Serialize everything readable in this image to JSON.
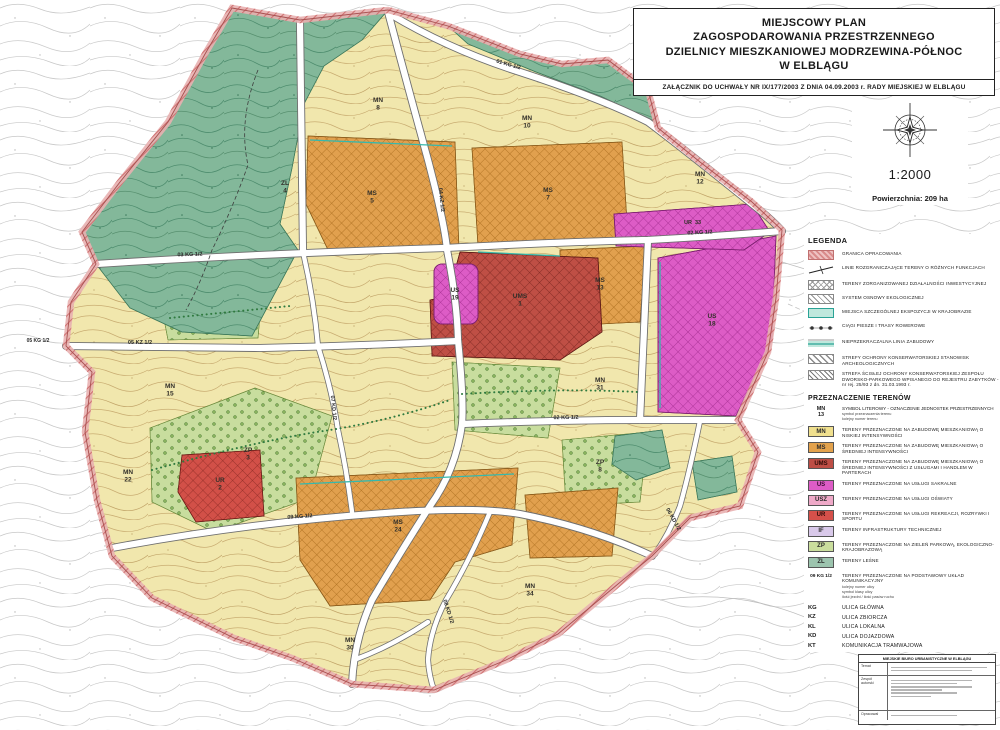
{
  "title_block": {
    "line1": "MIEJSCOWY PLAN",
    "line2": "ZAGOSPODAROWANIA PRZESTRZENNEGO",
    "line3": "DZIELNICY MIESZKANIOWEJ MODRZEWINA-PÓŁNOC",
    "line4": "W ELBLĄGU",
    "attachment": "ZAŁĄCZNIK DO UCHWAŁY  NR IX/177/2003  Z DNIA  04.09.2003 r.  RADY MIEJSKIEJ W ELBLĄGU"
  },
  "scale_text": "1:2000",
  "area_text": "Powierzchnia: 209 ha",
  "legend": {
    "heading": "LEGENDA",
    "items": [
      {
        "label": "GRANICA OPRACOWANIA"
      },
      {
        "label": "LINIE ROZGRANICZAJĄCE TERENY O RÓŻNYCH FUNKCJACH"
      },
      {
        "label": "TERENY ZORGANIZOWANEJ DZIAŁALNOŚCI INWESTYCYJNEJ"
      },
      {
        "label": "SYSTEM OSNOWY EKOLOGICZNEJ"
      },
      {
        "label": "MIEJSCA SZCZEGÓLNEJ EKSPOZYCJI W KRAJOBRAZIE"
      },
      {
        "label": "CIĄGI PIESZE I TRASY ROWEROWE"
      },
      {
        "label": "NIEPRZEKRACZALNA LINIA ZABUDOWY"
      },
      {
        "label": "STREFY OCHRONY KONSERWATORSKIEJ STANOWISK ARCHEOLOGICZNYCH"
      },
      {
        "label": "STREFA ŚCISŁEJ OCHRONY KONSERWATORSKIEJ ZESPOŁU DWORSKO-PARKOWEGO WPISANEGO DO REJESTRU ZABYTKÓW - nr rej. 25/93 z dn. 31.03.1993 r."
      }
    ]
  },
  "zoning": {
    "heading": "PRZEZNACZENIE TERENÓW",
    "symbol_note": {
      "code_top": "MN",
      "code_num": "13",
      "label": "SYMBOL LITEROWY - OZNACZENIE JEDNOSTEK PRZESTRZENNYCH",
      "sub1": "symbol przeznaczenia terenu",
      "sub2": "kolejny numer terenu"
    },
    "items": [
      {
        "code": "MN",
        "color": "#f0e08e",
        "label": "TERENY PRZEZNACZONE NA ZABUDOWĘ MIESZKANIOWĄ O NISKIEJ INTENSYWNOŚCI"
      },
      {
        "code": "MS",
        "color": "#e3a24c",
        "label": "TERENY PRZEZNACZONE NA ZABUDOWĘ MIESZKANIOWĄ O ŚREDNIEJ INTENSYWNOŚCI"
      },
      {
        "code": "UMS",
        "color": "#bd4d45",
        "label": "TERENY PRZEZNACZONE NA ZABUDOWĘ MIESZKANIOWĄ O ŚREDNIEJ INTENSYWNOŚCI Z USŁUGAMI I HANDLEM W PARTERACH"
      },
      {
        "code": "US",
        "color": "#dd5cc6",
        "label": "TERENY PRZEZNACZONE NA USŁUGI SAKRALNE"
      },
      {
        "code": "USZ",
        "color": "#efa9c8",
        "label": "TERENY PRZEZNACZONE NA USŁUGI OŚWIATY"
      },
      {
        "code": "UR",
        "color": "#d5504a",
        "label": "TERENY PRZEZNACZONE NA USŁUGI REKREACJI, ROZRYWKI I SPORTU"
      },
      {
        "code": "IF",
        "color": "#d9c9ea",
        "label": "TERENY INFRASTRUKTURY TECHNICZNEJ"
      },
      {
        "code": "ZP",
        "color": "#cade9d",
        "label": "TERENY PRZEZNACZONE NA ZIELEŃ PARKOWĄ, EKOLOGICZNO-KRAJOBRAZOWĄ"
      },
      {
        "code": "ZL",
        "color": "#9cc4ae",
        "label": "TERENY LEŚNE"
      }
    ],
    "roads_note": {
      "symbol": "09 KG 1/2",
      "label": "TERENY PRZEZNACZONE NA PODSTAWOWY UKŁAD KOMUNIKACYJNY",
      "sub1": "kolejny numer ulicy",
      "sub2": "symbol klasy ulicy",
      "sub3": "ilość jezdni / ilość pasów ruchu"
    },
    "road_classes": [
      {
        "code": "KG",
        "label": "ULICA GŁÓWNA"
      },
      {
        "code": "KZ",
        "label": "ULICA ZBIORCZA"
      },
      {
        "code": "KL",
        "label": "ULICA LOKALNA"
      },
      {
        "code": "KD",
        "label": "ULICA DOJAZDOWA"
      },
      {
        "code": "KT",
        "label": "KOMUNIKACJA TRAMWAJOWA"
      }
    ]
  },
  "stamp": {
    "header": "MIEJSKIE BIURO URBANISTYCZNE W ELBLĄGU",
    "row1_label": "Temat",
    "row2_label": "Zespół autorski",
    "row3_label": "Opracował"
  },
  "map": {
    "road_labels": [
      "01 KG 1/2",
      "03 KG 1/2",
      "02 KG 1/2",
      "04 KZ 1/2",
      "05 KZ 1/2",
      "05 KG 1/2",
      "02 KG 1/2",
      "09 KG 1/2",
      "08 KD 1/2",
      "07 KD 1/2",
      "06 KD 1/2"
    ],
    "zone_labels": [
      {
        "c": "ZL",
        "n": "4"
      },
      {
        "c": "MN",
        "n": "8"
      },
      {
        "c": "MS",
        "n": "5"
      },
      {
        "c": "MN",
        "n": "10"
      },
      {
        "c": "MS",
        "n": "7"
      },
      {
        "c": "MN",
        "n": "12"
      },
      {
        "c": "UR",
        "n": "33"
      },
      {
        "c": "MS",
        "n": "13"
      },
      {
        "c": "UMS",
        "n": "1"
      },
      {
        "c": "US",
        "n": "19"
      },
      {
        "c": "US",
        "n": "18"
      },
      {
        "c": "MN",
        "n": "31"
      },
      {
        "c": "ZP",
        "n": "3"
      },
      {
        "c": "UR",
        "n": "2"
      },
      {
        "c": "MN",
        "n": "15"
      },
      {
        "c": "MN",
        "n": "22"
      },
      {
        "c": "MS",
        "n": "24"
      },
      {
        "c": "ZP",
        "n": "8"
      },
      {
        "c": "MN",
        "n": "34"
      },
      {
        "c": "MN",
        "n": "30"
      }
    ]
  }
}
